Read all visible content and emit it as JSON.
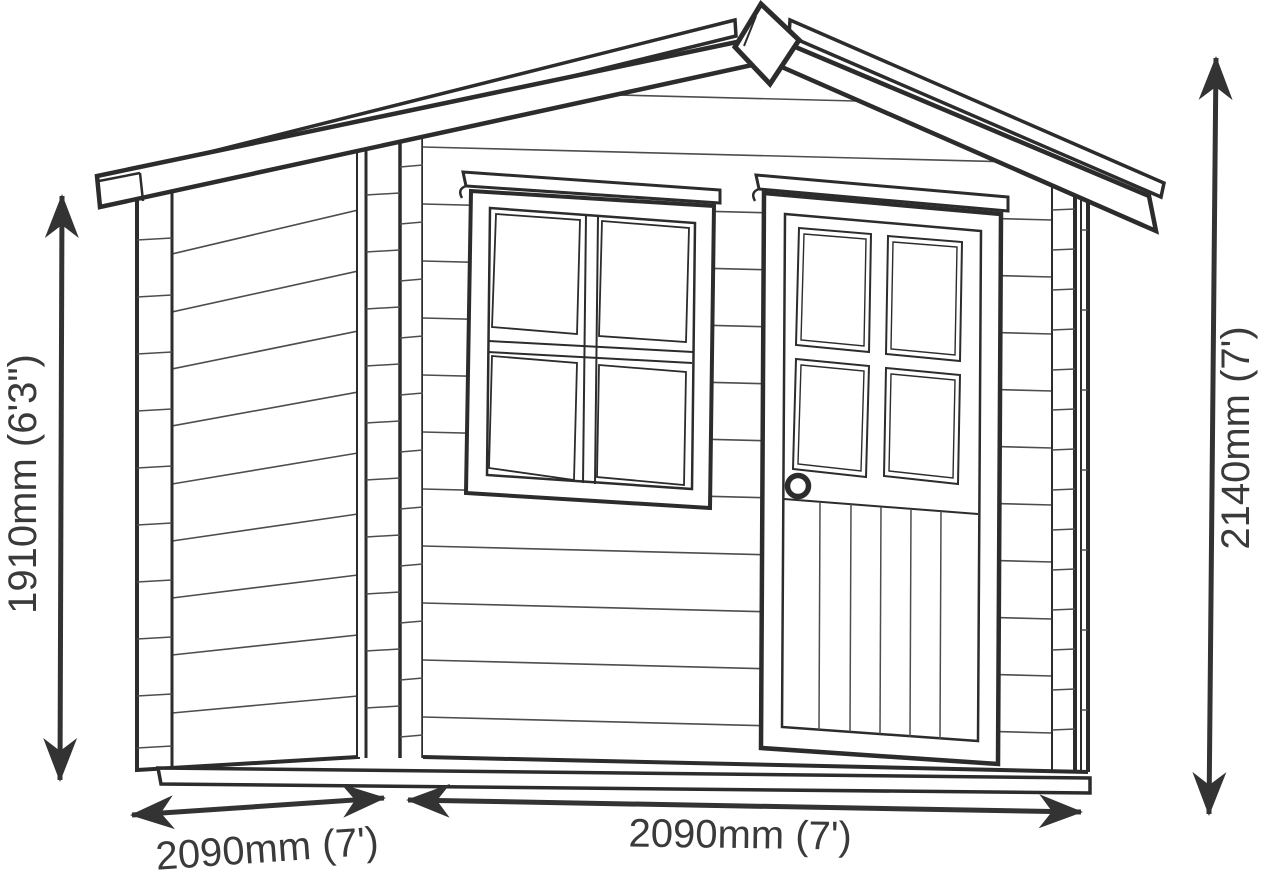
{
  "page": {
    "background": "#ffffff"
  },
  "diagram": {
    "subject": "log-cabin garden shed technical line drawing",
    "line_color": "#2c2c2c",
    "text_color": "#3a3a3a",
    "dimensions": {
      "left_height": "1910mm (6'3\")",
      "right_height": "2140mm (7')",
      "bottom_left_width": "2090mm (7')",
      "bottom_right_width": "2090mm (7')"
    }
  }
}
